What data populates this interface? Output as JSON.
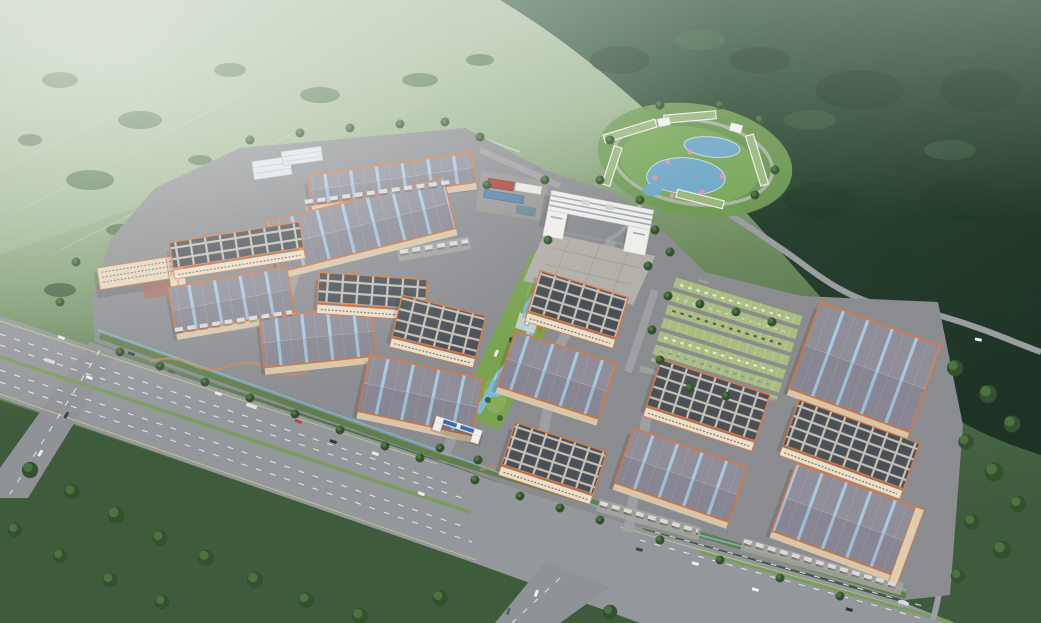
{
  "meta": {
    "kind": "3d-architectural-aerial-rendering",
    "subject": "industrial logistics park campus beside a highway, surrounded by green hills and forest",
    "view": "bird's-eye oblique",
    "image_width_px": 1041,
    "image_height_px": 623,
    "visible_text": "none"
  },
  "labels": {
    "scene": "Aerial rendering of an industrial logistics park campus",
    "background": "Misty green hills and dark forested mountain",
    "fields": "Farm fields with tree rows",
    "highway": "Multi-lane highway with median and traffic",
    "intersection": "Road intersection with south exit road",
    "campus": "Paved campus ground with internal streets",
    "perimeter": "Perimeter hedge and teal boundary wall",
    "gate": "Main entrance gate with blue sign panels",
    "river_strip": "Central landscaped strip with winding stream and fountains",
    "plaza": "Paved plaza in front of headquarters",
    "office": "White multi-story headquarters building",
    "dormitory": "Multi-story dormitory block with courtyard",
    "utility": "Utility sheds with red and blue roofs",
    "resort": "Resort hotel ring with lagoon ponds and pink trees",
    "parking": "Grass-grid parking lot with parked cars",
    "warehouse": "Warehouse with skylight-striped gray roof and orange trim",
    "factory": "Factory building with dark paneled roof",
    "shed": "Small white ribbed-roof shed",
    "trucks": "Rows of trailer trucks at loading docks",
    "vehicles": "Cars and trucks on the roads",
    "trees": "Trees and shrubs",
    "mist": "Atmospheric haze"
  },
  "palette": {
    "hill_light": "#b9c7b0",
    "hill_mid": "#9db58f",
    "field_green": "#5d7a52",
    "field_dark": "#3e5c3d",
    "forest_dark": "#27402e",
    "forest_deep": "#1e3326",
    "tree_dark": "#2d4a2e",
    "tree_mid": "#33512f",
    "tree_highlight": "#4a7340",
    "asphalt": "#94979b",
    "campus_ground": "#8b8c90",
    "concrete_apron": "#a9a7a2",
    "lane_marking": "#e8eaec",
    "edge_line": "#c6cd8a",
    "median_green": "#7d9c5f",
    "boundary_teal": "#7cb4c2",
    "roof_gray": "#8f8e99",
    "skylight_blue": "#a9c9e3",
    "trim_orange": "#d97840",
    "panel_dark": "#4b5057",
    "panel_frame": "#c6c1b7",
    "wall_cream": "#ecdfc7",
    "facade_cream": "#d9c6a8",
    "office_white": "#efeeea",
    "office_band": "#a0aab4",
    "resort_roof_green": "#9ab77e",
    "pond_blue": "#6fa8c8",
    "river_blue": "#7fb9d8",
    "river_light": "#a8d4ea",
    "lawn_green": "#79a351",
    "parking_cell_green": "#a9bd80",
    "flower_pink": "#d795b1",
    "bush_orange": "#c4703e",
    "dorm_wall": "#e8d5ba",
    "dorm_trim": "#c87a50",
    "courtyard_red": "#b06a58",
    "gate_blue": "#3a6ab8",
    "truck_trailer": "#d9dadc",
    "dock_bumper": "#a05040"
  },
  "inventory": {
    "striped_roof_warehouses": 9,
    "paneled_roof_factories": 7,
    "white_sheds": 2,
    "dormitory_blocks": 1,
    "office_hq_blocks": 1,
    "resort_buildings": 6,
    "ponds": 3,
    "stream_fountains": 2,
    "parking_lots": 1,
    "entrance_gates": 1,
    "loading_truck_rows": 5,
    "road_vehicle_count_approx": 22
  }
}
